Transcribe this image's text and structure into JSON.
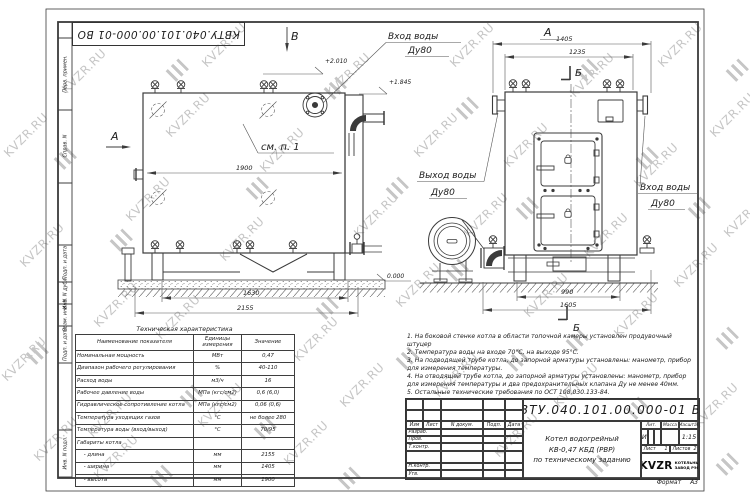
{
  "watermark": {
    "text": "KVZR.RU"
  },
  "sheet": {
    "doc_number_stamp": "КВТУ.040.101.00.000-01 ВО",
    "margin_labels": [
      "Перв. примен.",
      "Справ. N",
      "Подп. и дата",
      "Инв. N дубл.",
      "Взам. инв. N",
      "Подп. и дата",
      "Инв. N подл."
    ]
  },
  "side_view": {
    "view_b": "В",
    "view_a": "А",
    "inlet_label": "Вход воды",
    "inlet_dn": "Ду80",
    "see_note": "см. п. 1",
    "elev_top": "+2.010",
    "elev_mid": "+1.845",
    "elev_zero": "0.000",
    "dim_width": "1900",
    "dim_base": "1630",
    "dim_total": "2155"
  },
  "front_view": {
    "view_a": "А",
    "section_top": "Б",
    "section_bottom": "Б",
    "outlet_label": "Выход воды",
    "outlet_dn": "Ду80",
    "inlet_label": "Вход воды",
    "inlet_dn": "Ду80",
    "dim_total": "1405",
    "dim_inner": "1235",
    "dim_base_inner": "990",
    "dim_base_outer": "1605"
  },
  "tech_table": {
    "title": "Техническая характеристика",
    "headers": [
      "Наименование показателя",
      "Единицы измерения",
      "Значение"
    ],
    "rows": [
      [
        "Номинальная мощность",
        "МВт",
        "0,47"
      ],
      [
        "Диапазон рабочего регулирования",
        "%",
        "40-110"
      ],
      [
        "Расход воды",
        "м3/ч",
        "16"
      ],
      [
        "Рабочее давление воды",
        "МПа (кгс/см2)",
        "0,6 (6,0)"
      ],
      [
        "Гидравлическое сопротивление котла",
        "МПа (кгс/см2)",
        "0,06 (0,6)"
      ],
      [
        "Температура уходящих газов",
        "°С",
        "не более 280"
      ],
      [
        "Температура воды (вход/выход)",
        "°С",
        "70/95"
      ],
      [
        "Габариты котла",
        "",
        ""
      ],
      [
        "    - длина",
        "мм",
        "2155"
      ],
      [
        "    - ширина",
        "мм",
        "1405"
      ],
      [
        "    - высота",
        "мм",
        "1900"
      ]
    ]
  },
  "notes": [
    "1.  На боковой стенке котла в области топочной камеры установлен продувочный штуцер",
    "2.  Температура воды на входе 70°С, на выходе 95°С.",
    "3.  На подводящей трубе котла, до запорной арматуры установлены: манометр, прибор для измерения температуры.",
    "4.  На отводящей трубе котла, до запорной арматуры установлены: манометр, прибор для измерения температуры и два предохранительных клапана Ду не менее 40мм.",
    "5.  Остальные технические требования по ОСТ 108.030.133-84."
  ],
  "title_block": {
    "doc_number": "КВТУ.040.101.00.000-01 ВО",
    "title_line1": "Котел водогрейный",
    "title_line2": "КВ-0,47 КБД (РВР)",
    "title_line3": "по техническому заданию",
    "col_izm": "Изм",
    "col_list": "Лист",
    "col_doc": "N докум.",
    "col_sign": "Подп.",
    "col_date": "Дата",
    "row_developed": "Разраб.",
    "row_checked": "Пров.",
    "row_tcontrol": "Т.контр.",
    "row_ncontrol": "Н.контр.",
    "row_approved": "Утв.",
    "lit_header": "Лит.",
    "mass_header": "Масса",
    "scale_header": "Масштаб",
    "lit_value": "И",
    "scale_value": "1:15",
    "sheet_label": "Лист",
    "sheet_value": "1",
    "sheets_label": "Листов",
    "sheets_value": "2",
    "logo_text": "KVZR",
    "company_line1": "КОТЕЛЬНЫЙ",
    "company_line2": "ЗАВОД РЭП",
    "format_label": "Формат",
    "format_value": "А3"
  }
}
